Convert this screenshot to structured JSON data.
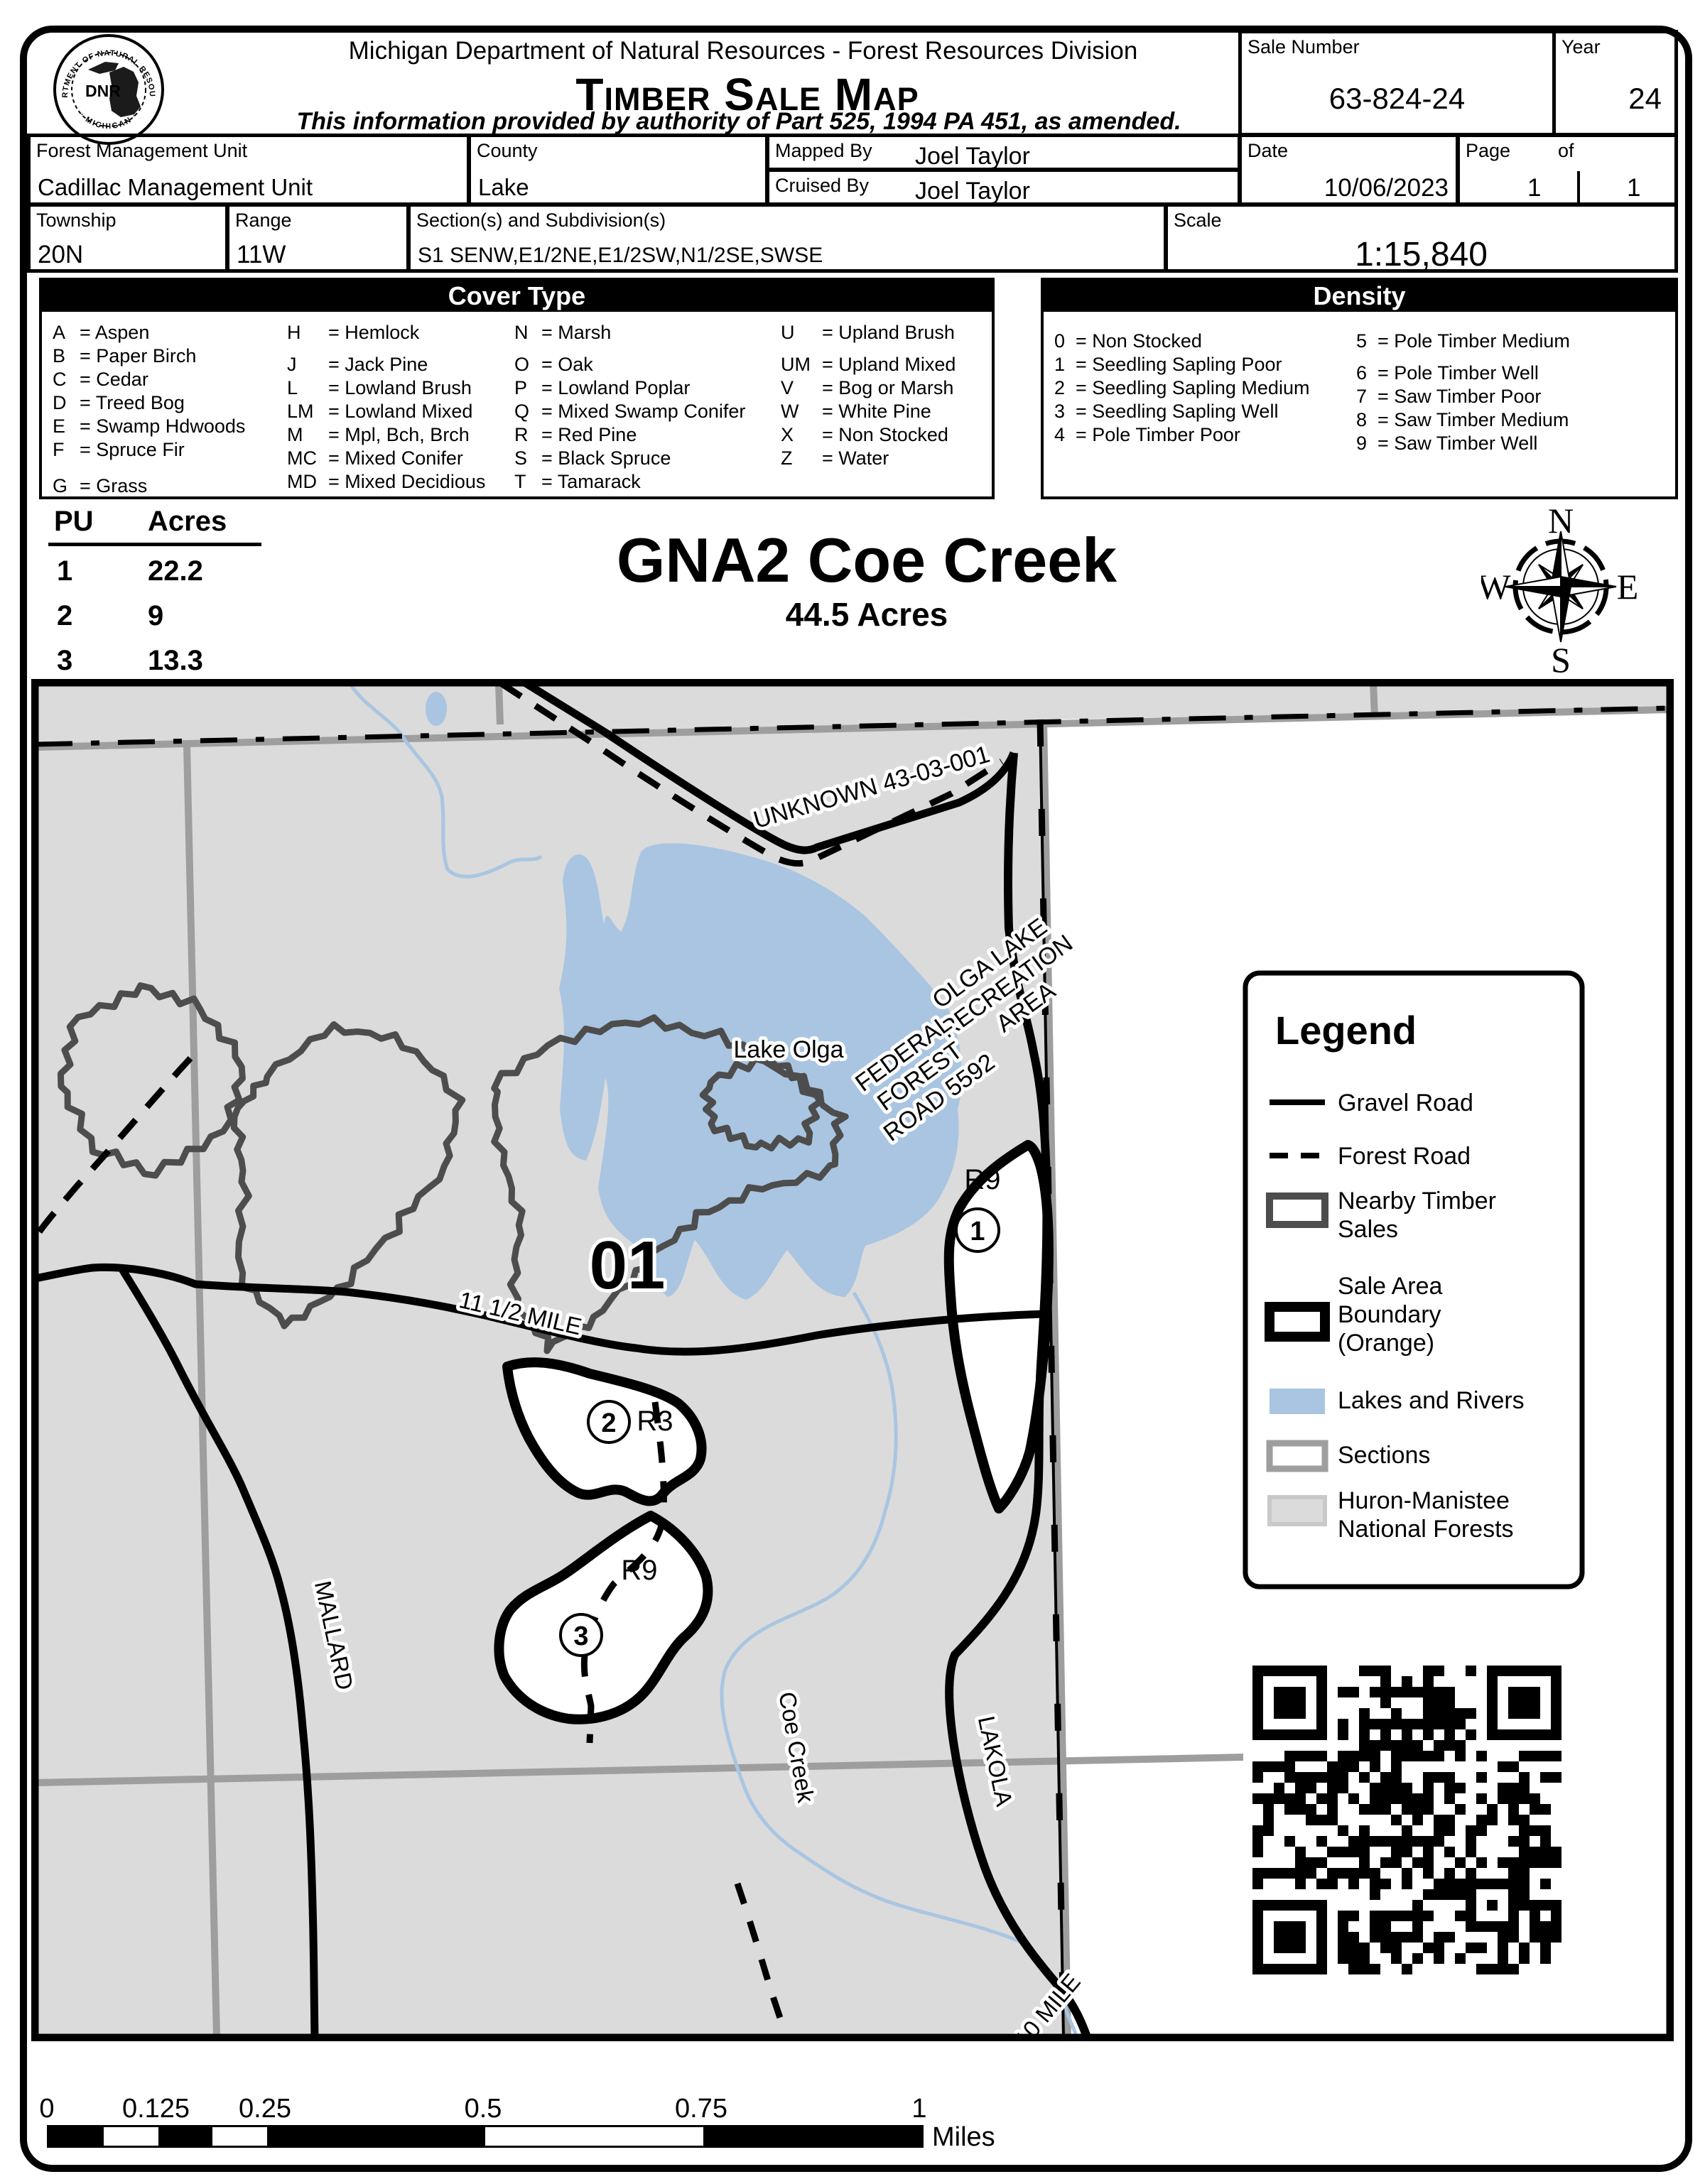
{
  "header": {
    "agency_line": "Michigan Department of Natural Resources - Forest Resources Division",
    "map_type_title": "Timber Sale Map",
    "authority_line": "This information provided by authority of Part 525, 1994 PA 451, as amended.",
    "logo": {
      "ring_top": "DEPARTMENT OF NATURAL RESOURCES",
      "ring_bottom": "· MICHIGAN ·",
      "acronym": "DNR"
    },
    "sale_number": {
      "label": "Sale Number",
      "value": "63-824-24"
    },
    "year": {
      "label": "Year",
      "value": "24"
    },
    "fmu": {
      "label": "Forest Management Unit",
      "value": "Cadillac Management Unit"
    },
    "county": {
      "label": "County",
      "value": "Lake"
    },
    "mapped_by": {
      "label": "Mapped By",
      "value": "Joel Taylor"
    },
    "cruised_by": {
      "label": "Cruised By",
      "value": "Joel Taylor"
    },
    "date": {
      "label": "Date",
      "value": "10/06/2023"
    },
    "page": {
      "label": "Page",
      "of_label": "of",
      "page_value": "1",
      "of_value": "1"
    },
    "township": {
      "label": "Township",
      "value": "20N"
    },
    "range": {
      "label": "Range",
      "value": "11W"
    },
    "sections": {
      "label": "Section(s) and Subdivision(s)",
      "value": "S1 SENW,E1/2NE,E1/2SW,N1/2SE,SWSE"
    },
    "scale": {
      "label": "Scale",
      "value": "1:15,840"
    }
  },
  "cover_type": {
    "title": "Cover Type",
    "columns": [
      [
        {
          "code": "A",
          "name": "Aspen"
        },
        {
          "code": "B",
          "name": "Paper Birch"
        },
        {
          "code": "C",
          "name": "Cedar"
        },
        {
          "code": "D",
          "name": "Treed Bog"
        },
        {
          "code": "E",
          "name": "Swamp Hdwoods"
        },
        {
          "code": "F",
          "name": "Spruce Fir"
        },
        {
          "code": "G",
          "name": "Grass"
        }
      ],
      [
        {
          "code": "H",
          "name": "Hemlock"
        },
        {
          "code": "J",
          "name": "Jack Pine"
        },
        {
          "code": "L",
          "name": "Lowland Brush"
        },
        {
          "code": "LM",
          "name": "Lowland Mixed"
        },
        {
          "code": "M",
          "name": "Mpl, Bch, Brch"
        },
        {
          "code": "MC",
          "name": "Mixed Conifer"
        },
        {
          "code": "MD",
          "name": "Mixed Decidious"
        }
      ],
      [
        {
          "code": "N",
          "name": "Marsh"
        },
        {
          "code": "O",
          "name": "Oak"
        },
        {
          "code": "P",
          "name": "Lowland Poplar"
        },
        {
          "code": "Q",
          "name": "Mixed Swamp Conifer"
        },
        {
          "code": "R",
          "name": "Red Pine"
        },
        {
          "code": "S",
          "name": "Black Spruce"
        },
        {
          "code": "T",
          "name": "Tamarack"
        }
      ],
      [
        {
          "code": "U",
          "name": "Upland Brush"
        },
        {
          "code": "UM",
          "name": "Upland Mixed"
        },
        {
          "code": "V",
          "name": "Bog or Marsh"
        },
        {
          "code": "W",
          "name": "White Pine"
        },
        {
          "code": "X",
          "name": "Non Stocked"
        },
        {
          "code": "Z",
          "name": "Water"
        }
      ]
    ]
  },
  "density": {
    "title": "Density",
    "columns": [
      [
        {
          "code": "0",
          "name": "Non Stocked"
        },
        {
          "code": "1",
          "name": "Seedling Sapling Poor"
        },
        {
          "code": "2",
          "name": "Seedling Sapling Medium"
        },
        {
          "code": "3",
          "name": "Seedling Sapling Well"
        },
        {
          "code": "4",
          "name": "Pole Timber Poor"
        }
      ],
      [
        {
          "code": "5",
          "name": "Pole Timber Medium"
        },
        {
          "code": "6",
          "name": "Pole Timber Well"
        },
        {
          "code": "7",
          "name": "Saw Timber Poor"
        },
        {
          "code": "8",
          "name": "Saw Timber Medium"
        },
        {
          "code": "9",
          "name": "Saw Timber Well"
        }
      ]
    ]
  },
  "pu_table": {
    "headers": [
      "PU",
      "Acres"
    ],
    "rows": [
      [
        "1",
        "22.2"
      ],
      [
        "2",
        "9"
      ],
      [
        "3",
        "13.3"
      ]
    ]
  },
  "sale_title": {
    "name": "GNA2 Coe Creek",
    "acres": "44.5 Acres"
  },
  "compass": {
    "n": "N",
    "e": "E",
    "s": "S",
    "w": "W"
  },
  "map": {
    "compartment": "01",
    "labels": {
      "unknown_road": "UNKNOWN 43-03-001",
      "lake": "Lake Olga",
      "olga_rec": {
        "l1": "OLGA LAKE",
        "l2": "RECREATION",
        "l3": "AREA"
      },
      "ffr": {
        "l1": "FEDERAL",
        "l2": "FOREST",
        "l3": "ROAD 5592"
      },
      "mile115": "11 1/2 MILE",
      "mallard": "MALLARD",
      "coe_creek": "Coe Creek",
      "lakola": "LAKOLA",
      "mile10": "10 MILE"
    },
    "units": [
      {
        "pu": "1",
        "stand": "R9"
      },
      {
        "pu": "2",
        "stand": "R3"
      },
      {
        "pu": "3",
        "stand": "R9"
      }
    ]
  },
  "legend": {
    "title": "Legend",
    "items": [
      {
        "icon": "gravel-road",
        "lines": [
          "Gravel Road"
        ]
      },
      {
        "icon": "forest-road",
        "lines": [
          "Forest Road"
        ]
      },
      {
        "icon": "nearby-sales",
        "lines": [
          "Nearby Timber",
          "Sales"
        ]
      },
      {
        "icon": "sale-boundary",
        "lines": [
          "Sale Area",
          "Boundary",
          "(Orange)"
        ]
      },
      {
        "icon": "lakes",
        "lines": [
          "Lakes and Rivers"
        ]
      },
      {
        "icon": "sections",
        "lines": [
          "Sections"
        ]
      },
      {
        "icon": "huron",
        "lines": [
          "Huron-Manistee",
          "National Forests"
        ]
      }
    ]
  },
  "scale_bar": {
    "ticks": [
      "0",
      "0.125",
      "0.25",
      "0.5",
      "0.75",
      "1"
    ],
    "unit": "Miles"
  },
  "colors": {
    "forest_gray": "#dbdbdb",
    "water_blue": "#a9c5e1",
    "section_gray": "#9e9e9e",
    "nearby_gray": "#4d4d4d",
    "boundary_black": "#000000"
  }
}
